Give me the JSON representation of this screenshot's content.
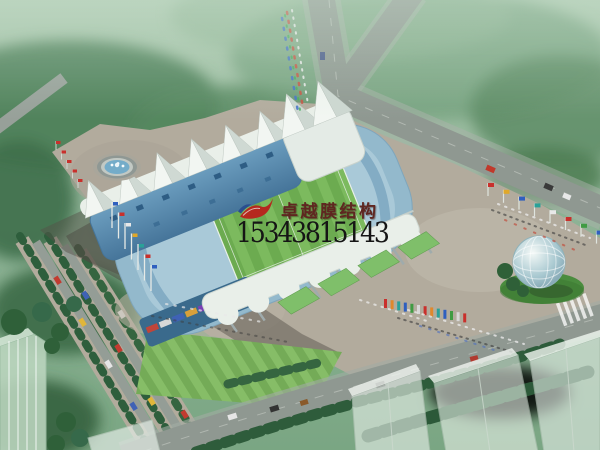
{
  "watermark": {
    "logo_icon": "red-swoosh-logo",
    "company_name": "卓越膜结构",
    "phone_number": "15343815143",
    "company_name_color": "#5f2620",
    "phone_number_color": "#151515",
    "logo_red": "#b5281e",
    "logo_blue": "#2a4e8f"
  },
  "scene_colors": {
    "haze_green_light": "#a9c7ac",
    "tree_green_dark": "#33663f",
    "plaza_tan": "#b2ab9d",
    "road_gray": "#8f9891",
    "stands_blue": "#93b9cc",
    "roof_blue": "#4f7fa2",
    "membrane_white": "#e9efe9",
    "pitch_green": "#6cab50",
    "facade_teal": "#3a6a8c",
    "sphere_glass_blue": "#a8c8d0",
    "lawn_green": "#74ab57"
  }
}
